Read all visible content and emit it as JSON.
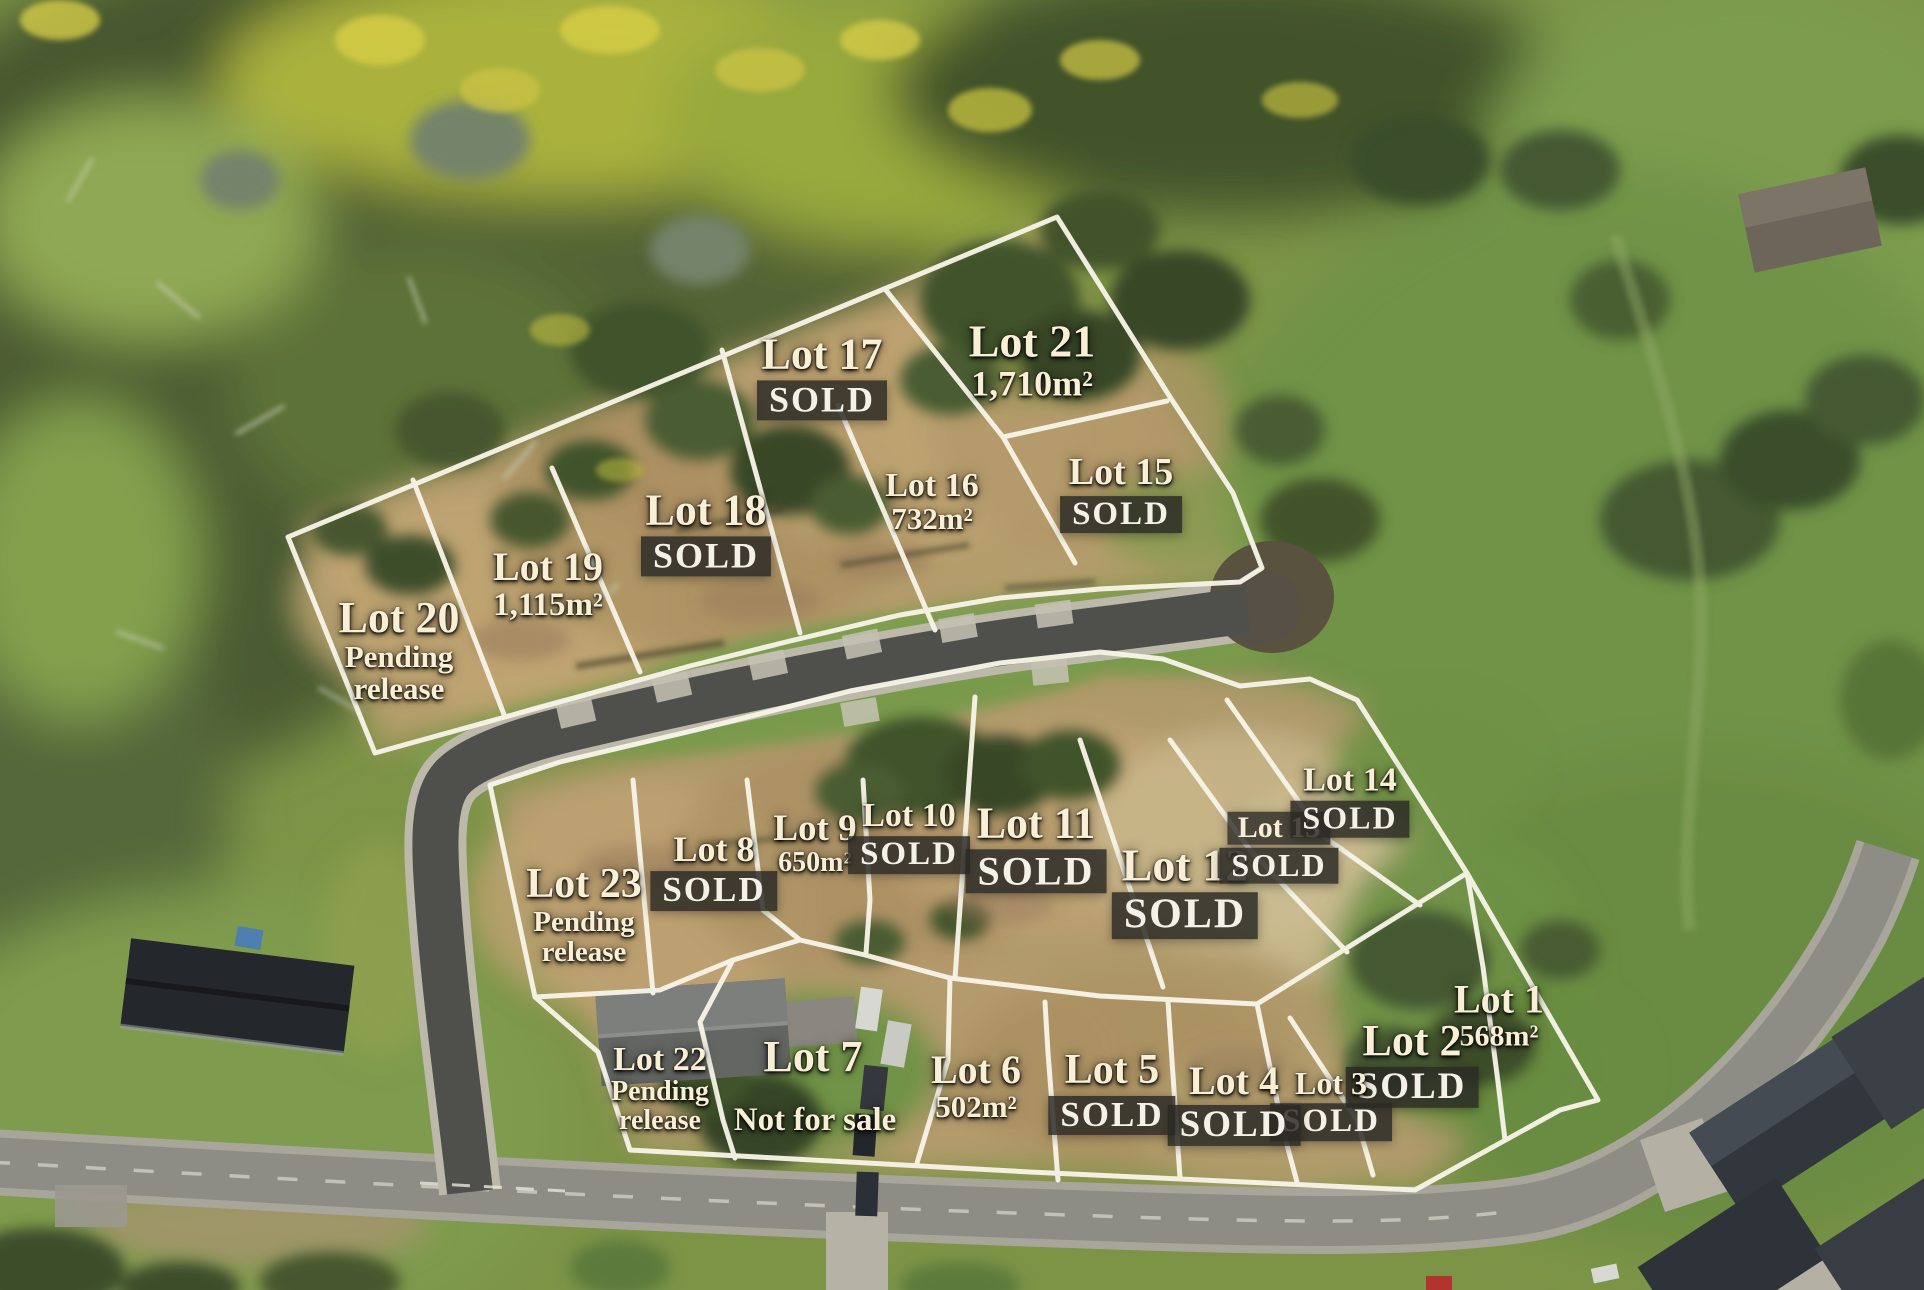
{
  "title": "Estate subdivision aerial lot map",
  "colors": {
    "boundary_line": "#f7f4e8",
    "label_text": "#f8efd6",
    "sold_box_bg": "rgba(42,41,37,0.84)",
    "sold_text": "#f4f2e8",
    "new_road_asphalt": "#4f4f4c",
    "old_road_asphalt": "#8d8d86"
  },
  "labels": [
    {
      "name": "lot-17-label",
      "x": 822,
      "y": 376,
      "lines": [
        {
          "text": "Lot 17",
          "kind": "name",
          "size": 44
        },
        {
          "text": "SOLD",
          "kind": "sold",
          "size": 36
        }
      ]
    },
    {
      "name": "lot-21-label",
      "x": 1032,
      "y": 360,
      "lines": [
        {
          "text": "Lot 21",
          "kind": "name",
          "size": 46
        },
        {
          "text": "1,710m²",
          "kind": "area",
          "size": 36
        }
      ]
    },
    {
      "name": "lot-18-label",
      "x": 706,
      "y": 532,
      "lines": [
        {
          "text": "Lot 18",
          "kind": "name",
          "size": 44
        },
        {
          "text": "SOLD",
          "kind": "sold",
          "size": 36
        }
      ]
    },
    {
      "name": "lot-16-label",
      "x": 932,
      "y": 502,
      "lines": [
        {
          "text": "Lot 16",
          "kind": "name",
          "size": 34
        },
        {
          "text": "732m²",
          "kind": "area",
          "size": 31
        }
      ]
    },
    {
      "name": "lot-15-label",
      "x": 1121,
      "y": 493,
      "lines": [
        {
          "text": "Lot 15",
          "kind": "name",
          "size": 38
        },
        {
          "text": "SOLD",
          "kind": "sold",
          "size": 33
        }
      ]
    },
    {
      "name": "lot-19-label",
      "x": 548,
      "y": 584,
      "lines": [
        {
          "text": "Lot 19",
          "kind": "name",
          "size": 40
        },
        {
          "text": "1,115m²",
          "kind": "area",
          "size": 33
        }
      ]
    },
    {
      "name": "lot-20-label",
      "x": 399,
      "y": 650,
      "lines": [
        {
          "text": "Lot 20",
          "kind": "name",
          "size": 44
        },
        {
          "text": "Pending",
          "kind": "note",
          "size": 31
        },
        {
          "text": "release",
          "kind": "note",
          "size": 31
        }
      ]
    },
    {
      "name": "lot-23-label",
      "x": 584,
      "y": 915,
      "lines": [
        {
          "text": "Lot 23",
          "kind": "name",
          "size": 42
        },
        {
          "text": "Pending",
          "kind": "note",
          "size": 29
        },
        {
          "text": "release",
          "kind": "note",
          "size": 29
        }
      ]
    },
    {
      "name": "lot-8-label",
      "x": 714,
      "y": 871,
      "lines": [
        {
          "text": "Lot 8",
          "kind": "name",
          "size": 36
        },
        {
          "text": "SOLD",
          "kind": "sold",
          "size": 35
        }
      ]
    },
    {
      "name": "lot-9-label",
      "x": 815,
      "y": 844,
      "lines": [
        {
          "text": "Lot 9",
          "kind": "name",
          "size": 37
        },
        {
          "text": "650m²",
          "kind": "area",
          "size": 28
        }
      ]
    },
    {
      "name": "lot-10-label",
      "x": 909,
      "y": 836,
      "lines": [
        {
          "text": "Lot 10",
          "kind": "name",
          "size": 34
        },
        {
          "text": "SOLD",
          "kind": "sold",
          "size": 33
        }
      ]
    },
    {
      "name": "lot-11-label",
      "x": 1036,
      "y": 847,
      "lines": [
        {
          "text": "Lot 11",
          "kind": "name",
          "size": 44
        },
        {
          "text": "SOLD",
          "kind": "sold",
          "size": 40
        }
      ]
    },
    {
      "name": "lot-12-label",
      "x": 1185,
      "y": 890,
      "lines": [
        {
          "text": "Lot 12",
          "kind": "name",
          "size": 46
        },
        {
          "text": "SOLD",
          "kind": "sold",
          "size": 42
        }
      ]
    },
    {
      "name": "lot-13-label",
      "x": 1279,
      "y": 848,
      "lines": [
        {
          "text": "Lot 13",
          "kind": "name-boxed",
          "size": 30
        },
        {
          "text": "SOLD",
          "kind": "sold",
          "size": 32
        }
      ]
    },
    {
      "name": "lot-14-label",
      "x": 1350,
      "y": 800,
      "lines": [
        {
          "text": "Lot 14",
          "kind": "name",
          "size": 34
        },
        {
          "text": "SOLD",
          "kind": "sold",
          "size": 32
        }
      ]
    },
    {
      "name": "lot-1-label",
      "x": 1499,
      "y": 1015,
      "lines": [
        {
          "text": "Lot 1",
          "kind": "name",
          "size": 40
        },
        {
          "text": "568m²",
          "kind": "area",
          "size": 30
        }
      ]
    },
    {
      "name": "lot-2-label",
      "x": 1412,
      "y": 1063,
      "lines": [
        {
          "text": "Lot 2",
          "kind": "name",
          "size": 44
        },
        {
          "text": "SOLD",
          "kind": "sold",
          "size": 37
        }
      ]
    },
    {
      "name": "lot-3-label",
      "x": 1331,
      "y": 1104,
      "lines": [
        {
          "text": "Lot 3",
          "kind": "name",
          "size": 32
        },
        {
          "text": "SOLD",
          "kind": "sold",
          "size": 33
        }
      ]
    },
    {
      "name": "lot-4-label",
      "x": 1234,
      "y": 1103,
      "lines": [
        {
          "text": "Lot 4",
          "kind": "name",
          "size": 40
        },
        {
          "text": "SOLD",
          "kind": "sold",
          "size": 37
        }
      ]
    },
    {
      "name": "lot-5-label",
      "x": 1112,
      "y": 1092,
      "lines": [
        {
          "text": "Lot 5",
          "kind": "name",
          "size": 42
        },
        {
          "text": "SOLD",
          "kind": "sold",
          "size": 35
        }
      ]
    },
    {
      "name": "lot-6-label",
      "x": 976,
      "y": 1086,
      "lines": [
        {
          "text": "Lot 6",
          "kind": "name",
          "size": 40
        },
        {
          "text": "502m²",
          "kind": "area",
          "size": 31
        }
      ]
    },
    {
      "name": "lot-7-name-label",
      "x": 813,
      "y": 1057,
      "lines": [
        {
          "text": "Lot 7",
          "kind": "name",
          "size": 44
        }
      ]
    },
    {
      "name": "lot-7-status-label",
      "x": 815,
      "y": 1120,
      "lines": [
        {
          "text": "Not for sale",
          "kind": "note",
          "size": 33
        }
      ]
    },
    {
      "name": "lot-22-label",
      "x": 660,
      "y": 1089,
      "lines": [
        {
          "text": "Lot 22",
          "kind": "name",
          "size": 34
        },
        {
          "text": "Pending",
          "kind": "note",
          "size": 28
        },
        {
          "text": "release",
          "kind": "note",
          "size": 28
        }
      ]
    }
  ]
}
